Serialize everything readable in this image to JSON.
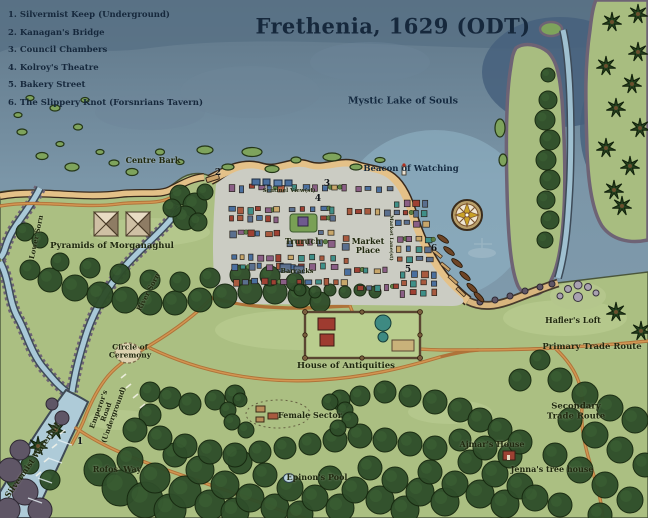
{
  "title": "Frethenia, 1629 (ODT)",
  "legend": {
    "items": [
      "1. Silvermist Keep (Underground)",
      "2. Kanagan's Bridge",
      "3. Council Chambers",
      "4. Kolroy's Theatre",
      "5. Bakery Street",
      "6. The Slippery Knot (Forsnrians Tavern)"
    ]
  },
  "labels": {
    "mystic_lake": "Mystic Lake of Souls",
    "beacon": "Beacon of Watching",
    "centre_bark": "Centre Bark",
    "sentinel_view": "Sentinel View(st)",
    "truruch": "Truruch",
    "market_place": "Market Place",
    "barracks": "Barracks",
    "market_lane": "Market Lane(st)",
    "pyramids": "Pyramids of Morganaghul",
    "lower_sorn": "Lower Sorn",
    "river_sorn": "River Sorn",
    "haflers_loft": "Hafler's Loft",
    "primary_trade_route": "Primary Trade Route",
    "circle_of_ceremony": "Circle of Ceremony",
    "house_of_antiquities": "House of Antiquities",
    "emperors_road": "Emperor's Road (Underground)",
    "silvermist_waterfall": "Silvermist Waterfall",
    "rofos_way": "Rofos' Way",
    "female_sector": "Female Sector",
    "epinons_pool": "Epinon's Pool",
    "ajmars_house": "Ajmar's House",
    "jennas_tree_house": "Jenna's tree house",
    "secondary_trade_route": "Secondary Trade Route"
  },
  "markers": {
    "m1": "1",
    "m2": "2",
    "m3": "3",
    "m4": "4",
    "m5": "5",
    "m6": "6"
  },
  "colors": {
    "water": "#7f9aac",
    "water_deep": "#50687e",
    "bay": "#8fb2c4",
    "land": "#abbf82",
    "forest": "#2f4e2a",
    "sand": "#e4c188",
    "road": "#b06f36",
    "river": "#a9c9d7",
    "rock": "#6e6375",
    "ink": "#16283c"
  }
}
